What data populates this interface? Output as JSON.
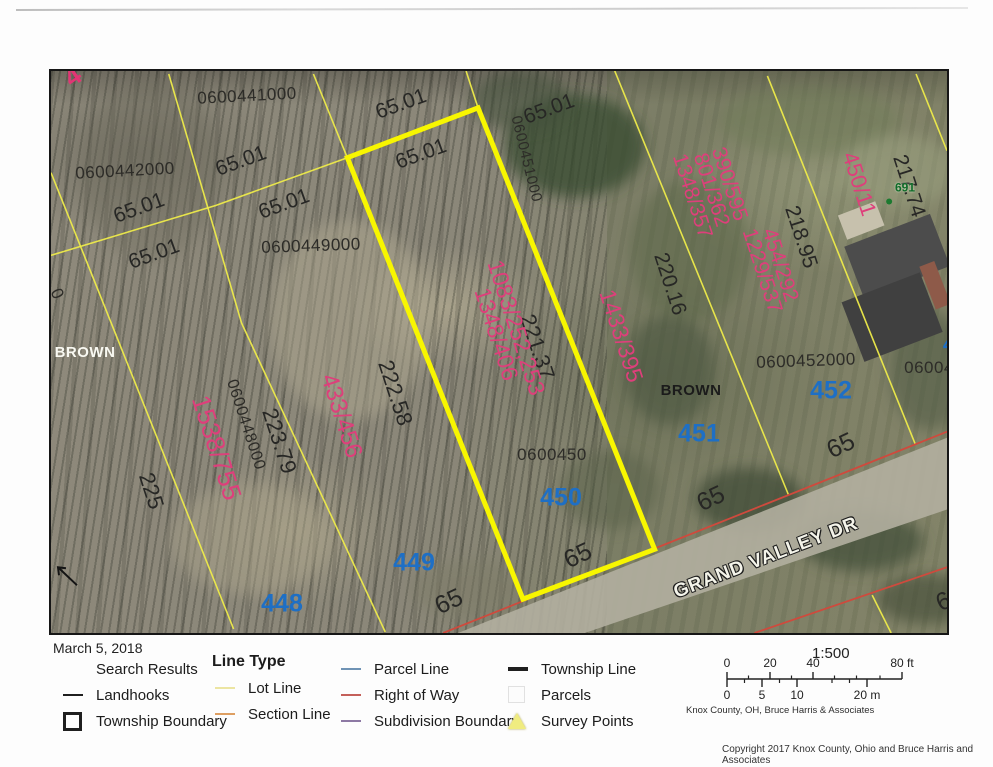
{
  "page": {
    "date": "March 5, 2018",
    "copyright": "Copyright 2017 Knox County, Ohio and Bruce Harris and Associates"
  },
  "colors": {
    "lot_line": "#eeeb4a",
    "highlight": "#f8f600",
    "right_of_way": "#cf4a3d",
    "deed_pink": "#de3f7b",
    "lot_blue": "#1e6fc5",
    "addr_green": "#0e6b28"
  },
  "map": {
    "labels": [
      {
        "kind": "parcel-id",
        "text": "0600441000",
        "x": 196,
        "y": 25,
        "rot": -3
      },
      {
        "kind": "parcel-id",
        "text": "0600442000",
        "x": 74,
        "y": 100,
        "rot": -3
      },
      {
        "kind": "parcel-id",
        "text": "0600449000",
        "x": 260,
        "y": 175,
        "rot": -2
      },
      {
        "kind": "parcel-id",
        "text": "0600448000",
        "x": 194,
        "y": 354,
        "rot": 72,
        "size": 16
      },
      {
        "kind": "parcel-id",
        "text": "0600450",
        "x": 501,
        "y": 384,
        "rot": 0
      },
      {
        "kind": "parcel-id",
        "text": "0600451000",
        "x": 475,
        "y": 88,
        "rot": 76,
        "size": 15
      },
      {
        "kind": "parcel-id",
        "text": "0600452000",
        "x": 755,
        "y": 290,
        "rot": -2
      },
      {
        "kind": "parcel-id",
        "text": "06004",
        "x": 878,
        "y": 297,
        "rot": 0
      },
      {
        "kind": "parcel-id",
        "text": "0",
        "x": 6,
        "y": 223,
        "rot": 65
      },
      {
        "kind": "dimension",
        "text": "65.01",
        "x": 88,
        "y": 137,
        "rot": -20
      },
      {
        "kind": "dimension",
        "text": "65.01",
        "x": 190,
        "y": 90,
        "rot": -20
      },
      {
        "kind": "dimension",
        "text": "65.01",
        "x": 233,
        "y": 133,
        "rot": -20
      },
      {
        "kind": "dimension",
        "text": "65.01",
        "x": 103,
        "y": 183,
        "rot": -20
      },
      {
        "kind": "dimension",
        "text": "65.01",
        "x": 350,
        "y": 33,
        "rot": -20
      },
      {
        "kind": "dimension",
        "text": "65.01",
        "x": 370,
        "y": 83,
        "rot": -20
      },
      {
        "kind": "dimension",
        "text": "65.01",
        "x": 498,
        "y": 38,
        "rot": -20
      },
      {
        "kind": "dimension",
        "text": "222.58",
        "x": 344,
        "y": 322,
        "rot": 72,
        "size": 22
      },
      {
        "kind": "dimension",
        "text": "221.37",
        "x": 486,
        "y": 276,
        "rot": 72,
        "size": 22
      },
      {
        "kind": "dimension",
        "text": "223.79",
        "x": 228,
        "y": 370,
        "rot": 72,
        "size": 22
      },
      {
        "kind": "dimension",
        "text": "225",
        "x": 100,
        "y": 420,
        "rot": 72,
        "size": 22
      },
      {
        "kind": "dimension",
        "text": "220.16",
        "x": 619,
        "y": 213,
        "rot": 72
      },
      {
        "kind": "dimension",
        "text": "218.95",
        "x": 750,
        "y": 166,
        "rot": 72
      },
      {
        "kind": "dimension",
        "text": "217.74",
        "x": 858,
        "y": 115,
        "rot": 72
      },
      {
        "kind": "dimension",
        "text": "65",
        "x": 398,
        "y": 531,
        "rot": -25,
        "size": 25
      },
      {
        "kind": "dimension",
        "text": "65",
        "x": 527,
        "y": 485,
        "rot": -25,
        "size": 25
      },
      {
        "kind": "dimension",
        "text": "65",
        "x": 660,
        "y": 428,
        "rot": -25,
        "size": 25
      },
      {
        "kind": "dimension",
        "text": "65",
        "x": 790,
        "y": 375,
        "rot": -25,
        "size": 25
      },
      {
        "kind": "dimension",
        "text": "65",
        "x": 899,
        "y": 528,
        "rot": -25,
        "size": 25
      },
      {
        "kind": "deed-ref",
        "text": "1538/755",
        "x": 165,
        "y": 377,
        "rot": 72,
        "size": 26
      },
      {
        "kind": "deed-ref",
        "text": "433/456",
        "x": 290,
        "y": 345,
        "rot": 72,
        "size": 24
      },
      {
        "kind": "deed-ref",
        "lines": [
          "1083/252,253",
          "1348/406"
        ],
        "x": 455,
        "y": 260,
        "rot": 72,
        "size": 23
      },
      {
        "kind": "deed-ref",
        "text": "1433/395",
        "x": 570,
        "y": 265,
        "rot": 72,
        "size": 23
      },
      {
        "kind": "deed-ref",
        "lines": [
          "390/595",
          "801/362",
          "1348/357"
        ],
        "x": 660,
        "y": 119,
        "rot": 72,
        "size": 21
      },
      {
        "kind": "deed-ref",
        "lines": [
          "454/292",
          "1229/537"
        ],
        "x": 720,
        "y": 197,
        "rot": 72,
        "size": 21
      },
      {
        "kind": "deed-ref",
        "text": "450/11",
        "x": 808,
        "y": 113,
        "rot": 72,
        "size": 22
      },
      {
        "kind": "survey-mark",
        "text": "4",
        "x": 22,
        "y": 6,
        "rot": -35
      },
      {
        "kind": "lot-number",
        "text": "448",
        "x": 231,
        "y": 533,
        "rot": 0
      },
      {
        "kind": "lot-number",
        "text": "449",
        "x": 363,
        "y": 492,
        "rot": 0
      },
      {
        "kind": "lot-number",
        "text": "450",
        "x": 510,
        "y": 427,
        "rot": 0
      },
      {
        "kind": "lot-number",
        "text": "451",
        "x": 648,
        "y": 363,
        "rot": 0
      },
      {
        "kind": "lot-number",
        "text": "452",
        "x": 780,
        "y": 320,
        "rot": 0
      },
      {
        "kind": "lot-number",
        "text": "45",
        "x": 903,
        "y": 274,
        "rot": 0,
        "size": 20
      },
      {
        "kind": "owner-light",
        "text": "BROWN",
        "x": 34,
        "y": 282,
        "rot": 0
      },
      {
        "kind": "owner-dark",
        "text": "BROWN",
        "x": 640,
        "y": 320,
        "rot": 0
      },
      {
        "kind": "street",
        "text": "GRAND VALLEY DR",
        "x": 715,
        "y": 487,
        "rot": -21
      },
      {
        "kind": "addr",
        "text": "691",
        "x": 854,
        "y": 117,
        "rot": 0
      }
    ],
    "shapes": {
      "blobs": [
        {
          "cx": 525,
          "cy": 75,
          "rx": 70,
          "ry": 52,
          "fill": "#36492f",
          "op": 0.75
        },
        {
          "cx": 470,
          "cy": 30,
          "rx": 50,
          "ry": 30,
          "fill": "#42503a",
          "op": 0.6
        },
        {
          "cx": 640,
          "cy": 180,
          "rx": 60,
          "ry": 70,
          "fill": "#5a6647",
          "op": 0.5
        },
        {
          "cx": 620,
          "cy": 300,
          "rx": 45,
          "ry": 55,
          "fill": "#47523d",
          "op": 0.55
        },
        {
          "cx": 700,
          "cy": 430,
          "rx": 55,
          "ry": 32,
          "fill": "#3d4935",
          "op": 0.7
        },
        {
          "cx": 812,
          "cy": 472,
          "rx": 62,
          "ry": 30,
          "fill": "#414d37",
          "op": 0.7
        },
        {
          "cx": 878,
          "cy": 530,
          "rx": 50,
          "ry": 25,
          "fill": "#3f4a36",
          "op": 0.6
        },
        {
          "cx": 880,
          "cy": 300,
          "rx": 40,
          "ry": 60,
          "fill": "#4a5440",
          "op": 0.5
        },
        {
          "cx": 560,
          "cy": 420,
          "rx": 50,
          "ry": 40,
          "fill": "#565e46",
          "op": 0.5
        },
        {
          "cx": 760,
          "cy": 50,
          "rx": 90,
          "ry": 35,
          "fill": "#6e7a57",
          "op": 0.5
        },
        {
          "cx": 850,
          "cy": 100,
          "rx": 60,
          "ry": 35,
          "fill": "#9aa07f",
          "op": 0.5
        },
        {
          "cx": 300,
          "cy": 250,
          "rx": 80,
          "ry": 100,
          "fill": "#b2ab93",
          "op": 0.45
        },
        {
          "cx": 200,
          "cy": 470,
          "rx": 80,
          "ry": 55,
          "fill": "#a9a28a",
          "op": 0.45
        },
        {
          "cx": 420,
          "cy": 520,
          "rx": 60,
          "ry": 30,
          "fill": "#7b7a66",
          "op": 0.5
        },
        {
          "cx": 100,
          "cy": 100,
          "rx": 70,
          "ry": 90,
          "fill": "#6f6d5f",
          "op": 0.4
        }
      ],
      "road": {
        "pts": "408,564 898,368 898,440 535,564",
        "fill": "#b3afa0",
        "op": 0.9
      },
      "buildings": [
        {
          "cx": 812,
          "cy": 150,
          "w": 40,
          "h": 26,
          "rot": -21,
          "fill": "#c7c1ad"
        },
        {
          "cx": 848,
          "cy": 186,
          "w": 92,
          "h": 56,
          "rot": -21,
          "fill": "#4c4c4c"
        },
        {
          "cx": 843,
          "cy": 247,
          "w": 84,
          "h": 64,
          "rot": -21,
          "fill": "#404040"
        },
        {
          "cx": 886,
          "cy": 215,
          "w": 16,
          "h": 46,
          "rot": -21,
          "fill": "#8e5a49"
        }
      ],
      "yellow_thin": [
        {
          "name": "section-cross-line",
          "pts": "0,185 165,135 297,87"
        },
        {
          "name": "lot-line",
          "pts": "428,37 416,0"
        },
        {
          "name": "lot-line",
          "pts": "118,3 191,253 335,563"
        },
        {
          "name": "lot-line",
          "pts": "0,102 52,232 183,560"
        },
        {
          "name": "lot-line",
          "pts": "263,3 297,87"
        },
        {
          "name": "lot-line",
          "pts": "565,0 739,425"
        },
        {
          "name": "lot-line",
          "pts": "718,5 820,260 866,374"
        },
        {
          "name": "lot-line",
          "pts": "867,3 898,80"
        },
        {
          "name": "lot-line",
          "pts": "823,526 842,564"
        }
      ],
      "highlight_pts": "297,87 428,37 605,480 473,530",
      "red_lines": [
        {
          "name": "right-of-way-line",
          "pts": "393,564 898,362"
        },
        {
          "name": "right-of-way-line",
          "pts": "705,564 898,498"
        }
      ],
      "landhook_path": "M26,516 L7,498 M15,499 L7,498 L8,506",
      "dot": {
        "x": 840,
        "y": 131,
        "r": 3,
        "fill": "#1c7a30"
      }
    }
  },
  "legend": {
    "columns": [
      {
        "x": 60,
        "dy": 0,
        "rows": [
          {
            "label": "Search Results",
            "symbol": "none"
          },
          {
            "label": "Landhooks",
            "symbol": "dash",
            "color": "#1f1f1f"
          },
          {
            "label": "Township Boundary",
            "symbol": "square",
            "color": "#1f1f1f"
          }
        ]
      },
      {
        "x": 212,
        "dy": -7,
        "rows": [
          {
            "label": "Line Type",
            "header": true
          },
          {
            "label": "Lot Line",
            "symbol": "dash",
            "color": "#ece5a2"
          },
          {
            "label": "Section Line",
            "symbol": "dash",
            "color": "#de9f62"
          }
        ]
      },
      {
        "x": 338,
        "dy": 0,
        "rows": [
          {
            "label": "Parcel Line",
            "symbol": "dash",
            "color": "#6f93b5"
          },
          {
            "label": "Right of Way",
            "symbol": "dash",
            "color": "#c4605a"
          },
          {
            "label": "Subdivision Boundary",
            "symbol": "dash",
            "color": "#8d79a4"
          }
        ]
      },
      {
        "x": 505,
        "dy": 0,
        "rows": [
          {
            "label": "Township Line",
            "symbol": "dash-thick",
            "color": "#1f1f1f"
          },
          {
            "label": "Parcels",
            "symbol": "square-faint",
            "color": "#e3e3e3"
          },
          {
            "label": "Survey Points",
            "symbol": "triangle",
            "color": "#f0ec80"
          }
        ]
      }
    ]
  },
  "scalebar": {
    "ratio": "1:500",
    "attribution": "Knox County, OH, Bruce Harris & Associates",
    "ft_labels": [
      {
        "t": "0",
        "x": 0
      },
      {
        "t": "20",
        "x": 43
      },
      {
        "t": "40",
        "x": 86
      },
      {
        "t": "80 ft",
        "x": 175
      }
    ],
    "m_labels": [
      {
        "t": "0",
        "x": 0
      },
      {
        "t": "5",
        "x": 35
      },
      {
        "t": "10",
        "x": 70
      },
      {
        "t": "20 m",
        "x": 140
      }
    ],
    "bar_px": 175,
    "ft_major": [
      0,
      43,
      86,
      175
    ],
    "ft_minor": [
      21.5,
      64.5,
      107.5,
      129.5,
      153
    ],
    "m_major": [
      0,
      35,
      70,
      140
    ],
    "m_minor": [
      17.5,
      52.5,
      105,
      122.5
    ]
  }
}
